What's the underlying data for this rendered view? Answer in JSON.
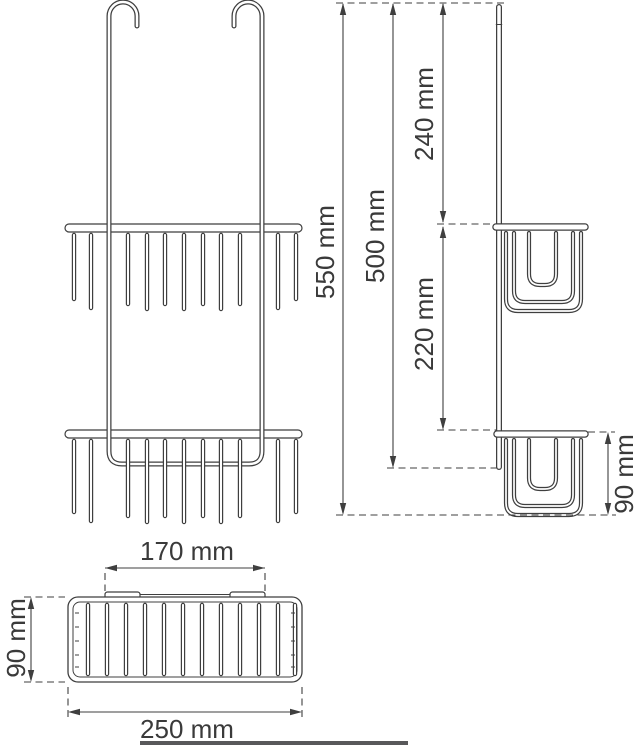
{
  "drawing": {
    "subject": "hanging-double-shower-basket",
    "views": [
      "front-view",
      "side-view",
      "top-view"
    ]
  },
  "dimension_labels": {
    "overall_height": "550 mm",
    "hanger_rail_height": "500 mm",
    "top_to_upper_basket": "240 mm",
    "upper_to_lower_basket": "220 mm",
    "basket_height_side": "90 mm",
    "hook_mount_span": "170 mm",
    "basket_depth_top": "90 mm",
    "basket_width": "250 mm"
  },
  "colors": {
    "line": "#3f3f3f",
    "text": "#3a3a3a",
    "background": "#ffffff",
    "bottom_bar": "#58585a"
  }
}
